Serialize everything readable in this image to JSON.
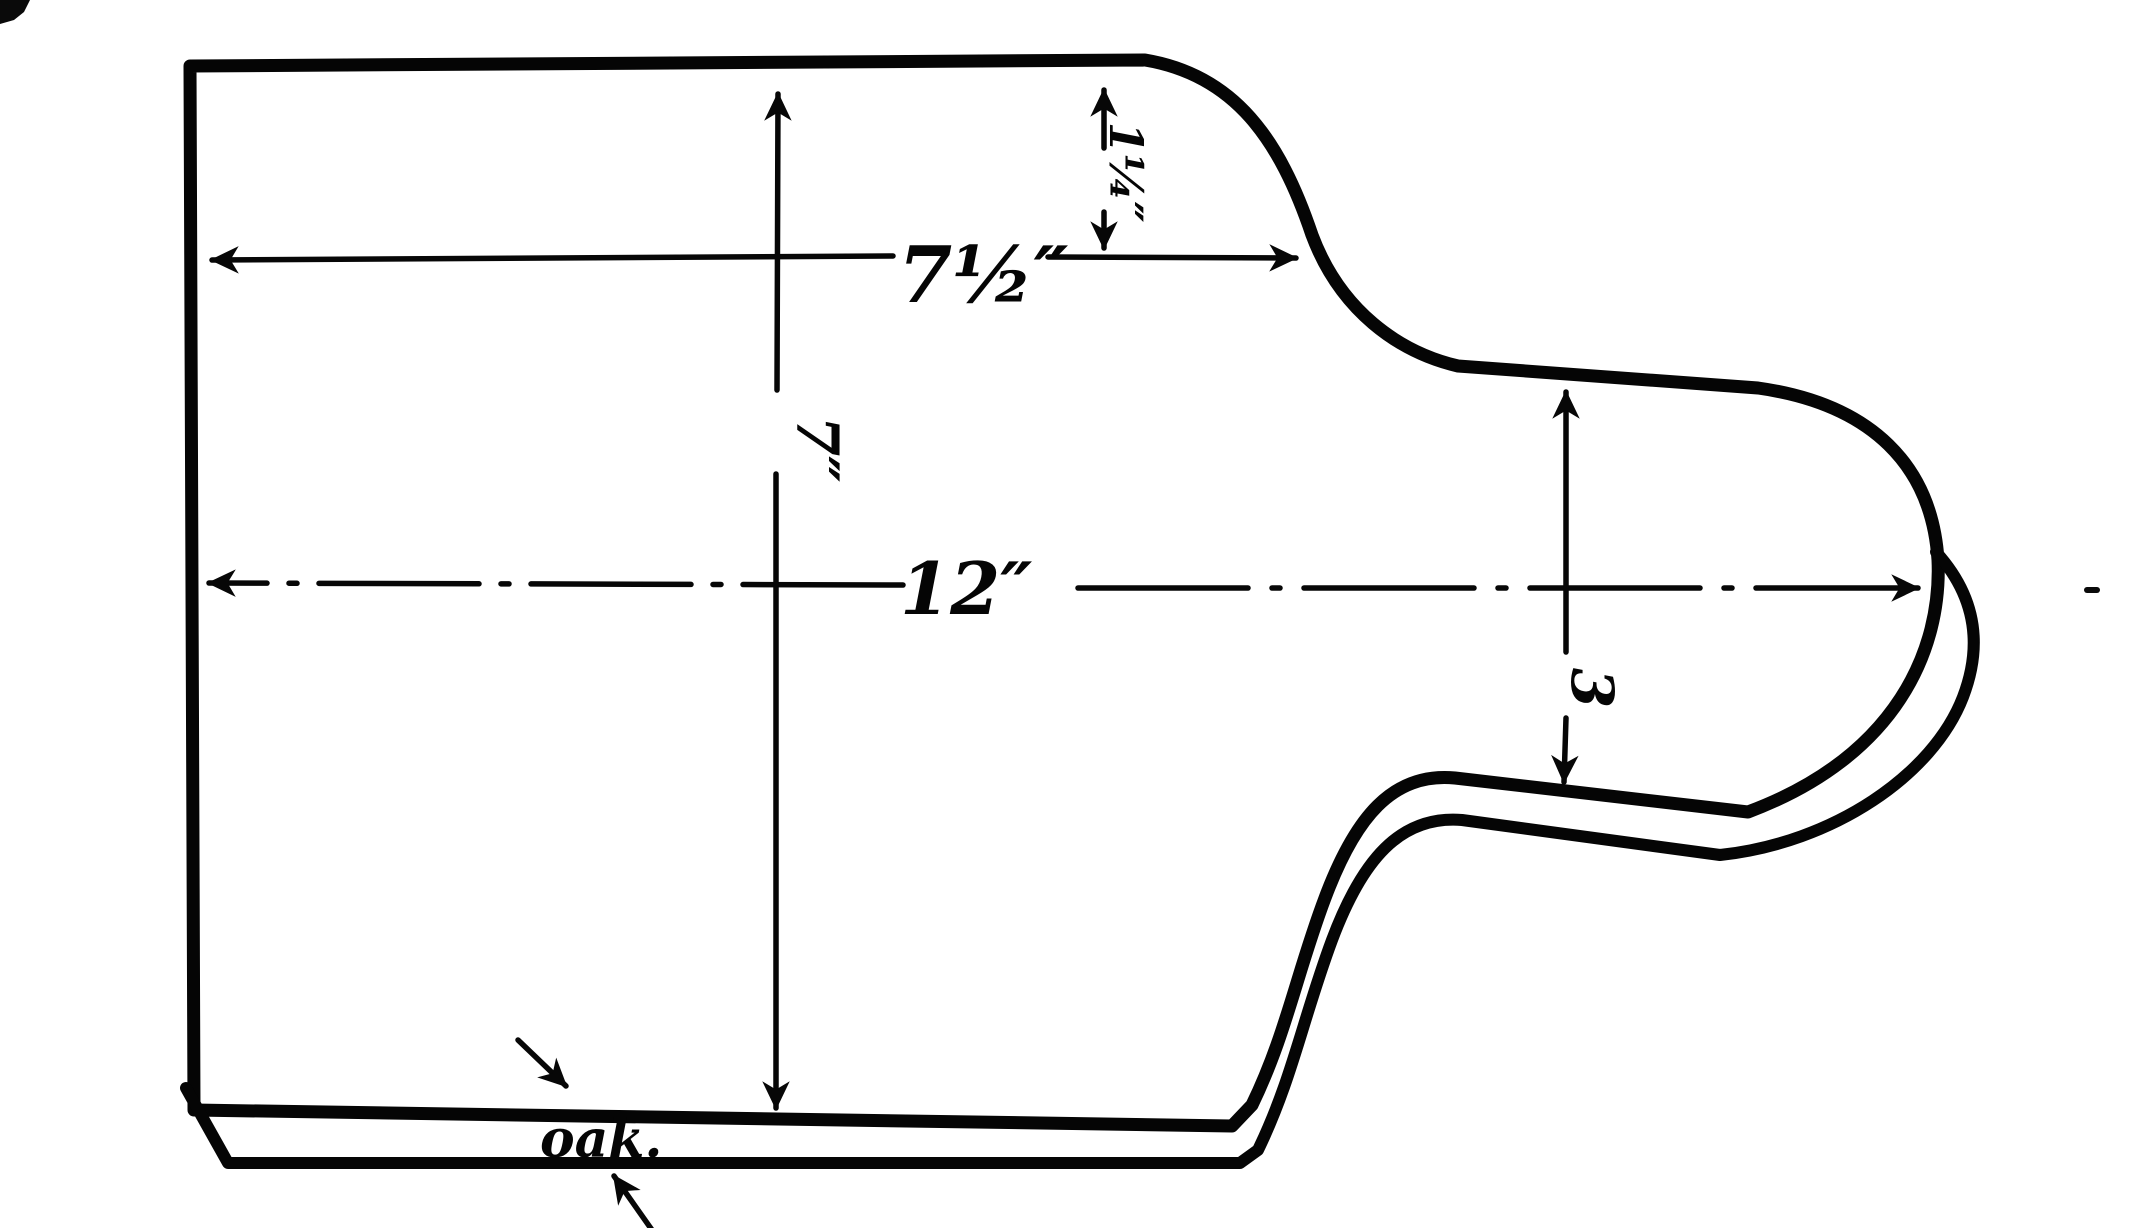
{
  "figure": {
    "kind": "hand-drawn dimensioned pattern of a board with rounded handle",
    "colors": {
      "ink": "#050505",
      "paper": "#ffffff"
    },
    "labels": {
      "shoulder_length": "7½″",
      "curve_drop": "1¼″",
      "overall_length": "12″",
      "board_width": "7″",
      "handle_width": "3",
      "material_note": "oak."
    }
  }
}
